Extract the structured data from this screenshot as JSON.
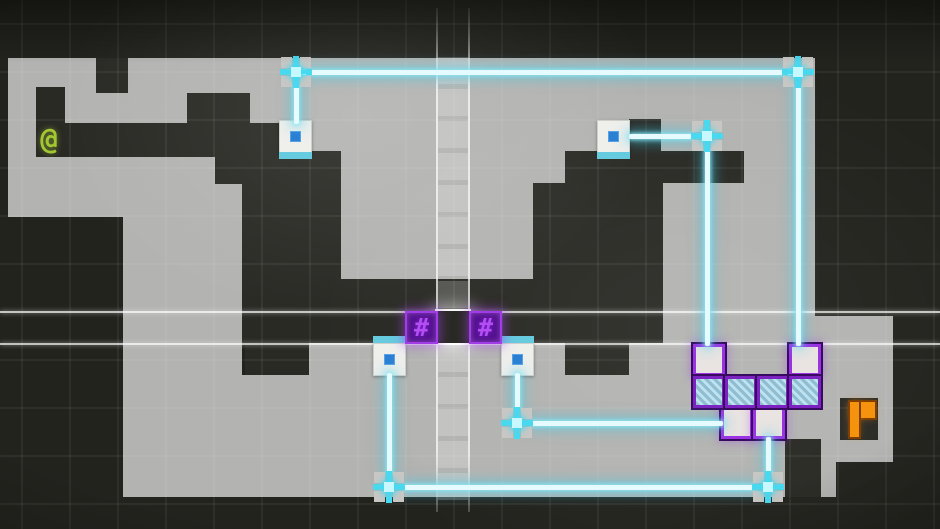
{
  "meta": {
    "app": "grid-puzzle-game",
    "view": "level-screen"
  },
  "glyphs": {
    "player": "@",
    "wall": "#"
  },
  "colors": {
    "background": "#23231e",
    "platform": "#b3b3b1",
    "pit": "#2a2a25",
    "beam_cyan": "#4ad9ef",
    "beam_core": "#e6fbff",
    "node_corner_gray": "#c8c7c4",
    "socket_blue": "#2b7fd4",
    "socket_strip_cyan": "#66cbdf",
    "purple_frame": "#9c33e3",
    "purple_fill": "#54128f",
    "hash_glyph_purple": "#b44ef2",
    "hatch_blue": "#8fbdd4",
    "exit_orange": "#f6930e",
    "player_green": "#a3c733",
    "highlight_white": "#ffffff"
  },
  "scene": {
    "platforms": [
      [
        8,
        58,
        807,
        65
      ],
      [
        8,
        123,
        807,
        28
      ],
      [
        8,
        151,
        207,
        32
      ],
      [
        8,
        183,
        115,
        34
      ],
      [
        123,
        183,
        119,
        314
      ],
      [
        341,
        151,
        224,
        128
      ],
      [
        663,
        151,
        152,
        192
      ],
      [
        309,
        343,
        317,
        154
      ],
      [
        626,
        343,
        210,
        154
      ],
      [
        815,
        316,
        78,
        146
      ],
      [
        242,
        375,
        67,
        122
      ]
    ],
    "pits": [
      [
        96,
        58,
        32,
        35
      ],
      [
        36,
        87,
        29,
        36
      ],
      [
        36,
        123,
        273,
        34
      ],
      [
        187,
        93,
        63,
        64
      ],
      [
        215,
        151,
        126,
        33
      ],
      [
        242,
        183,
        99,
        160
      ],
      [
        245,
        343,
        64,
        32
      ],
      [
        341,
        279,
        224,
        64
      ],
      [
        629,
        119,
        32,
        64
      ],
      [
        565,
        151,
        179,
        32
      ],
      [
        533,
        183,
        130,
        160
      ],
      [
        565,
        343,
        64,
        32
      ],
      [
        840,
        398,
        38,
        42
      ],
      [
        785,
        439,
        36,
        58
      ]
    ],
    "highlight": {
      "row_lines": [
        311,
        343
      ],
      "col_lines": [
        436,
        468
      ],
      "col_top": 8,
      "col_bottom": 512,
      "ladder": [
        438,
        55,
        30,
        448
      ],
      "center_cell": [
        437,
        311,
        32,
        32
      ]
    },
    "beams": [
      [
        296,
        72,
        798,
        72
      ],
      [
        296,
        84,
        296,
        124
      ],
      [
        798,
        84,
        798,
        346
      ],
      [
        629,
        136,
        695,
        136
      ],
      [
        707,
        148,
        707,
        346
      ],
      [
        389,
        373,
        389,
        475
      ],
      [
        401,
        487,
        756,
        487
      ],
      [
        768,
        437,
        768,
        475
      ],
      [
        517,
        373,
        517,
        411
      ],
      [
        529,
        423,
        723,
        423
      ]
    ],
    "nodes": [
      [
        296,
        72
      ],
      [
        798,
        72
      ],
      [
        707,
        136
      ],
      [
        389,
        487
      ],
      [
        768,
        487
      ],
      [
        517,
        423
      ]
    ],
    "sockets": [
      {
        "x": 279,
        "y": 120,
        "strip": "bottom"
      },
      {
        "x": 597,
        "y": 120,
        "strip": "bottom"
      },
      {
        "x": 373,
        "y": 343,
        "strip": "top"
      },
      {
        "x": 501,
        "y": 343,
        "strip": "top"
      }
    ],
    "hash_boxes": [
      [
        405,
        311
      ],
      [
        469,
        311
      ]
    ],
    "cluster": {
      "white_tiles": [
        [
          693,
          344
        ],
        [
          789,
          344
        ],
        [
          721,
          407
        ],
        [
          753,
          407
        ]
      ],
      "hatch_tiles": [
        [
          693,
          376
        ],
        [
          725,
          376
        ],
        [
          757,
          376
        ],
        [
          789,
          376
        ]
      ]
    },
    "player": {
      "cell": [
        33,
        122,
        32,
        34
      ]
    },
    "exit": {
      "cell": [
        840,
        398,
        38,
        42
      ],
      "stem": [
        10,
        4,
        9,
        35
      ],
      "flag": [
        10,
        4,
        25,
        16
      ]
    }
  }
}
